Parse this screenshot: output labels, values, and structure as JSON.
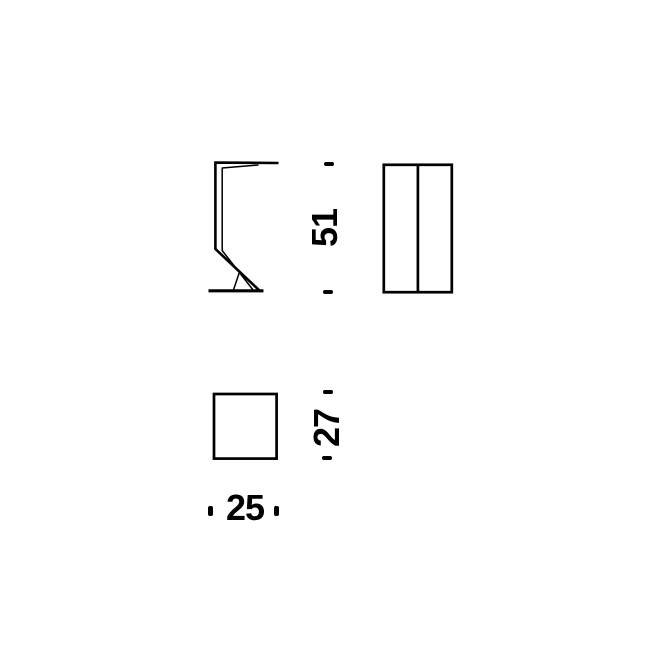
{
  "colors": {
    "ink": "#000000",
    "background": "#ffffff"
  },
  "dimensions": {
    "height": "51",
    "depth": "27",
    "width": "25"
  }
}
